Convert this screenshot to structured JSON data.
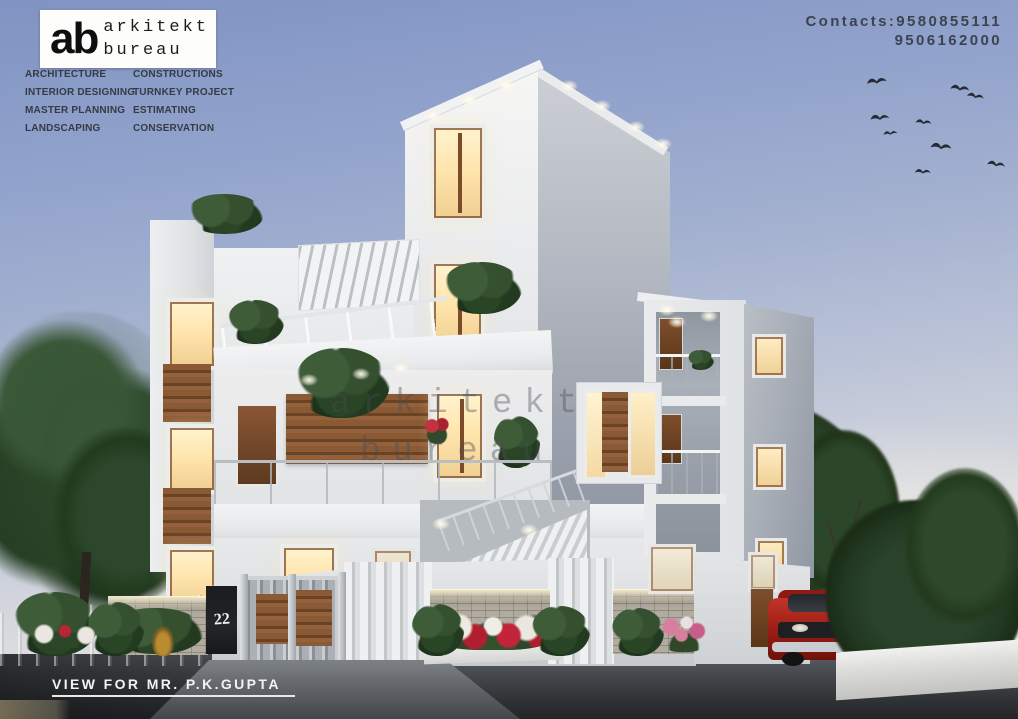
{
  "branding": {
    "logo_monogram": "ab",
    "logo_line1": "arkitekt",
    "logo_line2": "bureau",
    "services_col1": [
      "ARCHITECTURE",
      "INTERIOR DESIGNING",
      "MASTER PLANNING",
      "LANDSCAPING"
    ],
    "services_col2": [
      "CONSTRUCTIONS",
      "TURNKEY PROJECT",
      "ESTIMATING",
      "CONSERVATION"
    ],
    "contacts_line1": "Contacts:9580855111",
    "contacts_line2": "9506162000"
  },
  "watermark": {
    "line1": "arkitekt",
    "line2": "bureau"
  },
  "footer": {
    "caption": "VIEW FOR MR. P.K.GUPTA"
  },
  "scene": {
    "house_number": "22",
    "colors": {
      "sky_top": "#8093c2",
      "sky_horizon": "#ece9e1",
      "facade_white": "#eef0f1",
      "facade_shadow_gray": "#9aa1ac",
      "wood_accent": "#7e4e2c",
      "window_glow": "#ffe9bb",
      "foliage": "#2c4630",
      "car_red": "#a02017",
      "road_asphalt": "#3c3f43"
    }
  }
}
